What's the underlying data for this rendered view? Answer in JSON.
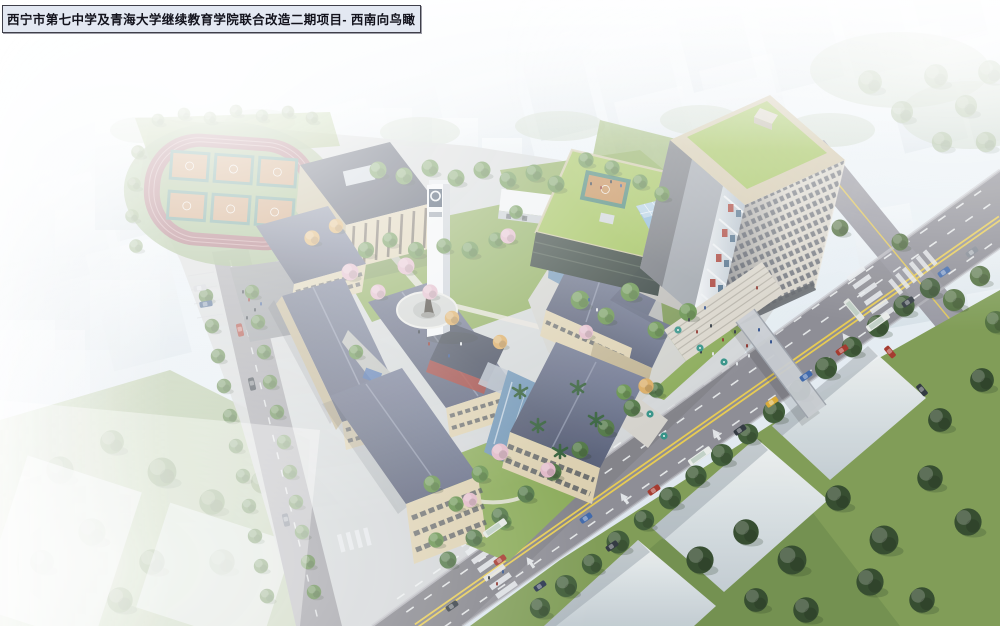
{
  "title": {
    "text": "西宁市第七中学及青海大学继续教育学院联合改造二期项目- 西南向鸟瞰"
  },
  "palette": {
    "sky_top": "#edf3f7",
    "sky_bottom": "#dce6ee",
    "track_red": "#96525c",
    "field_green": "#8cab72",
    "court_orange": "#c28a58",
    "court_teal": "#47857a",
    "roof_slate": "#59627e",
    "roof_dark": "#3e4557",
    "facade_cream": "#dbcfae",
    "facade_shade": "#bdb08d",
    "window_dark": "#454c55",
    "lawn_green": "#87a854",
    "tree_green": "#5e8c44",
    "tree_dark": "#3b5833",
    "blossom_pink": "#e0b6c6",
    "autumn_gold": "#d9a85c",
    "palm_green": "#2e5b34",
    "paving_gray": "#cfd0cc",
    "road_gray": "#8a8a92",
    "marking_yellow": "#e6c94e",
    "marking_white": "#eceff0",
    "tower_green_roof": "#9cbf52",
    "tower_parapet": "#cfc4a6",
    "glass_blue": "#86b4d6",
    "accent_red": "#a63c33",
    "water_blue": "#6d93b4",
    "park_green": "#7c9a52",
    "white_building": "#eef1f3",
    "title_bg": "#e3e8f2",
    "title_border": "#3f3f4a",
    "title_text": "#12121c"
  }
}
